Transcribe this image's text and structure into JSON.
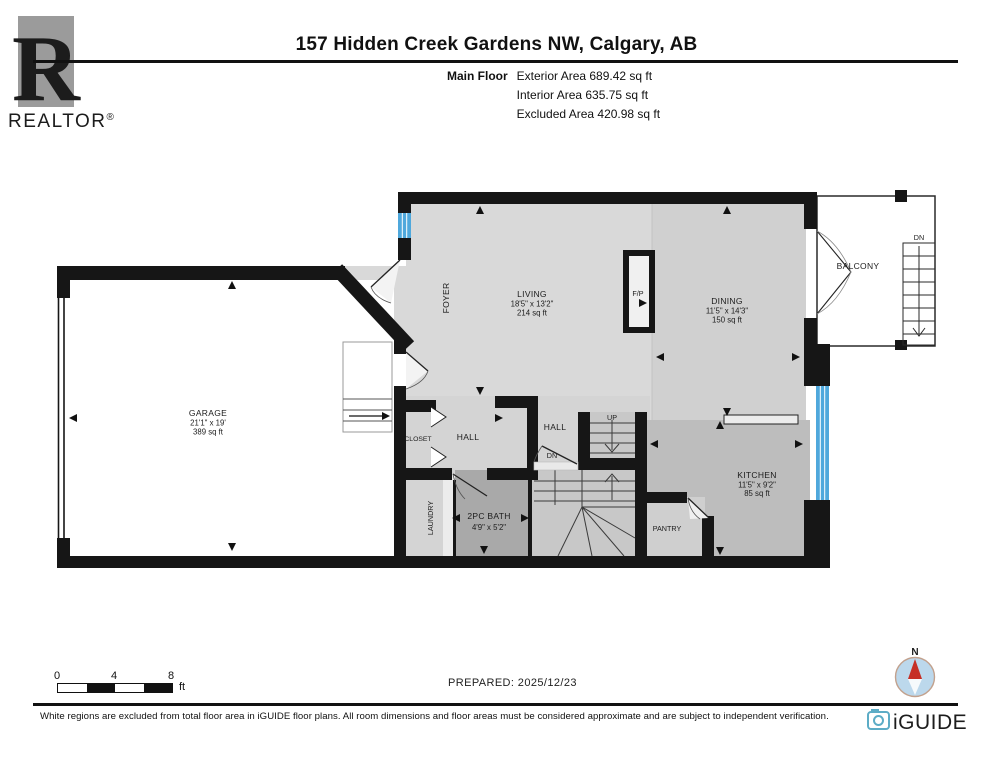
{
  "header": {
    "logo_letter": "R",
    "logo_word": "REALTOR",
    "logo_reg": "®",
    "title": "157 Hidden Creek Gardens NW, Calgary, AB",
    "floor_label": "Main Floor",
    "areas": [
      "Exterior Area 689.42 sq ft",
      "Interior Area 635.75 sq ft",
      "Excluded Area 420.98 sq ft"
    ]
  },
  "plan": {
    "rooms": {
      "garage": {
        "name": "GARAGE",
        "dims": "21'1\" x 19'",
        "area": "389 sq ft"
      },
      "living": {
        "name": "LIVING",
        "dims": "18'5\" x 13'2\"",
        "area": "214 sq ft"
      },
      "dining": {
        "name": "DINING",
        "dims": "11'5\" x 14'3\"",
        "area": "150 sq ft"
      },
      "kitchen": {
        "name": "KITCHEN",
        "dims": "11'5\" x 9'2\"",
        "area": "85 sq ft"
      },
      "bath": {
        "name": "2PC BATH",
        "dims": "4'9\" x 5'2\""
      },
      "foyer": {
        "name": "FOYER"
      },
      "hall_left": {
        "name": "HALL"
      },
      "hall_right": {
        "name": "HALL"
      },
      "closet": {
        "name": "CLOSET"
      },
      "laundry": {
        "name": "LAUNDRY"
      },
      "pantry": {
        "name": "PANTRY"
      },
      "balcony": {
        "name": "BALCONY"
      },
      "fireplace": {
        "name": "F/P"
      },
      "stairs_up": {
        "name": "UP"
      },
      "stairs_dn_hall": {
        "name": "DN"
      },
      "stairs_dn_balcony": {
        "name": "DN"
      }
    },
    "colors": {
      "wall": "#161616",
      "window_blue": "#4FA8DC",
      "floor_light": "#d9d9d9",
      "floor_kitchen": "#bdbdbd",
      "floor_bath": "#a9a9a9"
    }
  },
  "footer": {
    "scale": {
      "n0": "0",
      "n4": "4",
      "n8": "8",
      "unit": "ft"
    },
    "prepared": "PREPARED: 2025/12/23",
    "compass_n": "N",
    "disclaimer": "White regions are excluded from total floor area in iGUIDE floor plans. All room dimensions and floor areas must be considered approximate and are subject to independent verification.",
    "brand": "iGUIDE",
    "brand_color": "#5CACC6",
    "compass_red": "#C62F26"
  }
}
